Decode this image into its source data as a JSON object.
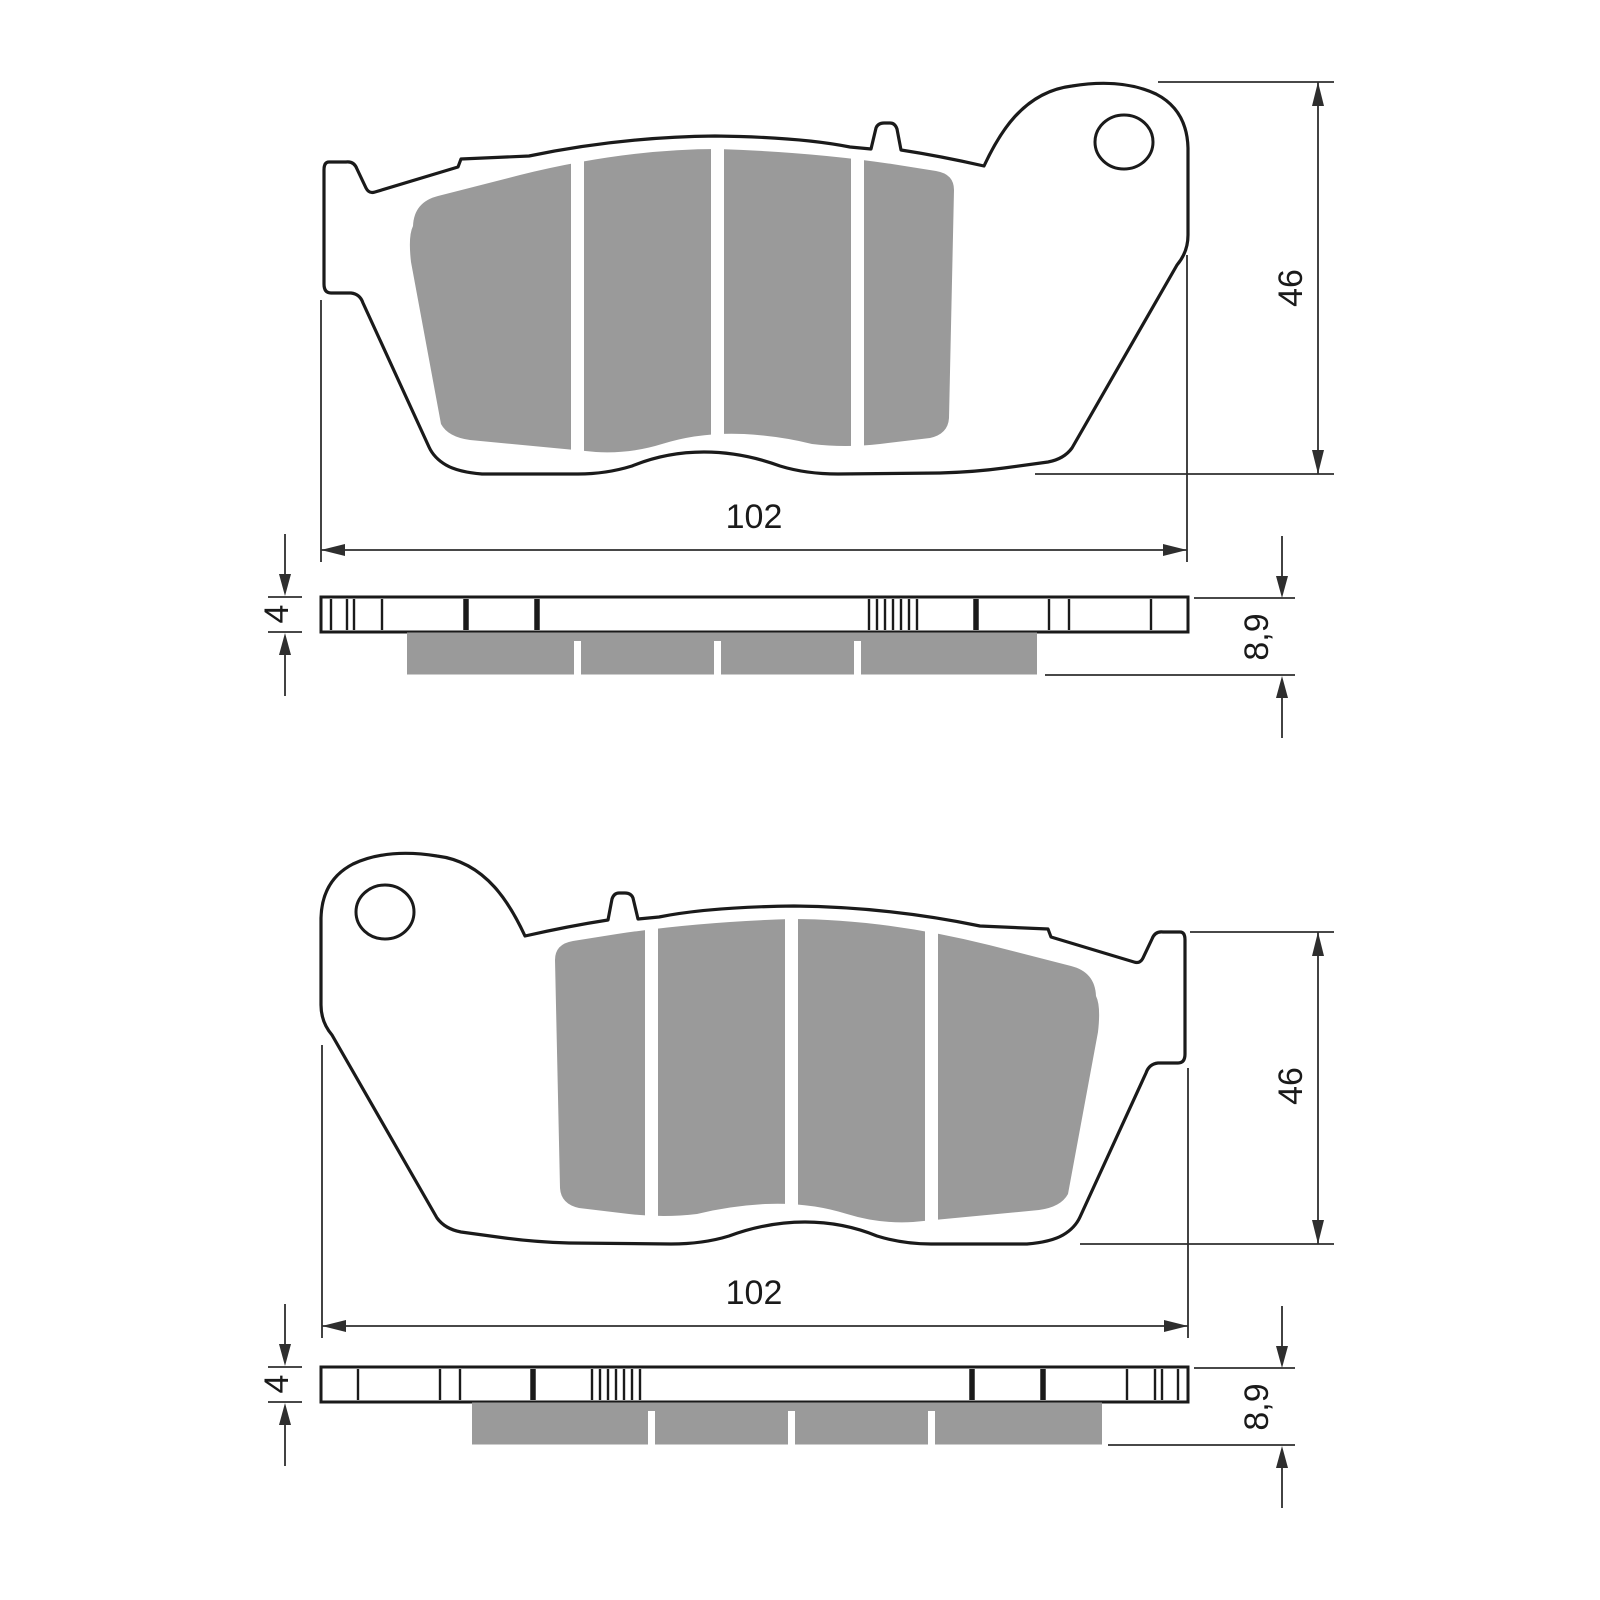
{
  "colors": {
    "outline": "#1a1a1a",
    "dimension": "#2e2e2e",
    "pad_gray": "#9a9a9a",
    "background": "#ffffff"
  },
  "top_drawing": {
    "dimensions": {
      "width": "102",
      "height": "46",
      "plate_thickness": "4",
      "total_thickness": "8,9"
    }
  },
  "bottom_drawing": {
    "dimensions": {
      "width": "102",
      "height": "46",
      "plate_thickness": "4",
      "total_thickness": "8,9"
    }
  }
}
